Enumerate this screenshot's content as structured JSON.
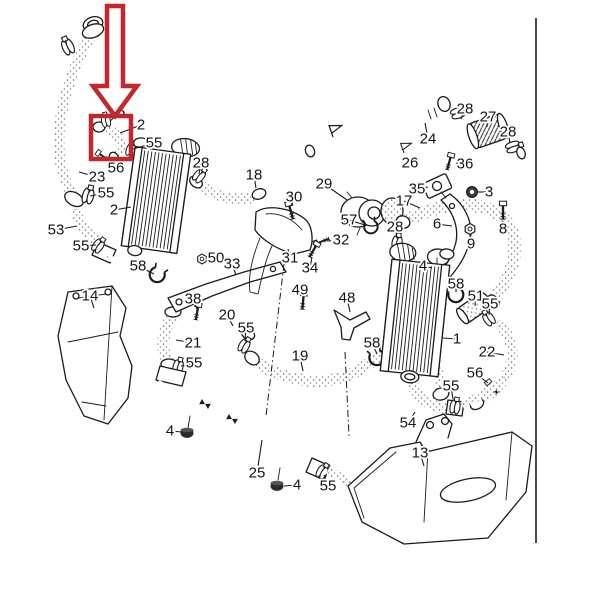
{
  "diagram": {
    "kind": "exploded-parts-diagram",
    "visible_part_numbers": [
      "1",
      "2",
      "3",
      "4",
      "5",
      "6",
      "8",
      "9",
      "13",
      "14",
      "17",
      "18",
      "19",
      "20",
      "21",
      "22",
      "23",
      "24",
      "25",
      "26",
      "27",
      "28",
      "29",
      "30",
      "31",
      "32",
      "33",
      "34",
      "35",
      "36",
      "38",
      "48",
      "49",
      "50",
      "51",
      "53",
      "54",
      "55",
      "56",
      "57",
      "58"
    ]
  },
  "colors": {
    "background": "#ffffff",
    "line": "#1b1b1b",
    "label": "#141414",
    "highlight": "#c1272d"
  },
  "frame": {
    "right_border": {
      "x": 536,
      "y1": 18,
      "y2": 543
    }
  },
  "highlight": {
    "box": {
      "x": 91,
      "y": 116,
      "w": 40,
      "h": 43
    },
    "arrow_points": "107,6 123,6 123,86 137,86 115,116 93,86 107,86",
    "stroke_width": 4.5
  },
  "labels": [
    {
      "n": "5",
      "x": 121,
      "y": 112,
      "lx": 110,
      "ly": 121
    },
    {
      "n": "2",
      "x": 141,
      "y": 125,
      "lx": 120,
      "ly": 133
    },
    {
      "n": "55",
      "x": 154,
      "y": 143,
      "lx": 133,
      "ly": 149
    },
    {
      "n": "56",
      "x": 116,
      "y": 168,
      "lx": 105,
      "ly": 158
    },
    {
      "n": "23",
      "x": 97,
      "y": 177,
      "lx": 79,
      "ly": 172
    },
    {
      "n": "55",
      "x": 106,
      "y": 193,
      "lx": 90,
      "ly": 196
    },
    {
      "n": "2",
      "x": 114,
      "y": 210,
      "lx": 131,
      "ly": 207
    },
    {
      "n": "53",
      "x": 56,
      "y": 230,
      "lx": 77,
      "ly": 226
    },
    {
      "n": "55",
      "x": 81,
      "y": 246,
      "lx": 96,
      "ly": 245
    },
    {
      "n": "28",
      "x": 201,
      "y": 163,
      "lx": 199,
      "ly": 174
    },
    {
      "n": "18",
      "x": 254,
      "y": 175,
      "lx": 256,
      "ly": 188
    },
    {
      "n": "58",
      "x": 138,
      "y": 266,
      "lx": 154,
      "ly": 274
    },
    {
      "n": "14",
      "x": 90,
      "y": 296,
      "lx": 94,
      "ly": 308
    },
    {
      "n": "38",
      "x": 193,
      "y": 299,
      "lx": 197,
      "ly": 309
    },
    {
      "n": "20",
      "x": 227,
      "y": 315,
      "lx": 233,
      "ly": 326
    },
    {
      "n": "21",
      "x": 193,
      "y": 343,
      "lx": 176,
      "ly": 340
    },
    {
      "n": "55",
      "x": 246,
      "y": 328,
      "lx": 245,
      "ly": 341
    },
    {
      "n": "55",
      "x": 194,
      "y": 363,
      "lx": 181,
      "ly": 366
    },
    {
      "n": "4",
      "x": 170,
      "y": 431,
      "lx": 182,
      "ly": 432
    },
    {
      "n": "25",
      "x": 257,
      "y": 473,
      "lx": 262,
      "ly": 440
    },
    {
      "n": "4",
      "x": 297,
      "y": 485,
      "lx": 284,
      "ly": 486
    },
    {
      "n": "55",
      "x": 328,
      "y": 486,
      "lx": 324,
      "ly": 475
    },
    {
      "n": "13",
      "x": 420,
      "y": 453,
      "lx": 424,
      "ly": 466
    },
    {
      "n": "54",
      "x": 408,
      "y": 423,
      "lx": 415,
      "ly": 412
    },
    {
      "n": "55",
      "x": 451,
      "y": 386,
      "lx": 453,
      "ly": 399
    },
    {
      "n": "19",
      "x": 300,
      "y": 356,
      "lx": 303,
      "ly": 371
    },
    {
      "n": "58",
      "x": 372,
      "y": 343,
      "lx": 377,
      "ly": 354
    },
    {
      "n": "29",
      "x": 324,
      "y": 184,
      "lx": 347,
      "ly": 200
    },
    {
      "n": "30",
      "x": 294,
      "y": 197,
      "lx": 291,
      "ly": 206
    },
    {
      "n": "57",
      "x": 349,
      "y": 220,
      "lx": 365,
      "ly": 225
    },
    {
      "n": "28",
      "x": 395,
      "y": 227,
      "lx": 397,
      "ly": 238
    },
    {
      "n": "32",
      "x": 341,
      "y": 240,
      "lx": 328,
      "ly": 241
    },
    {
      "n": "31",
      "x": 290,
      "y": 258,
      "lx": 288,
      "ly": 249
    },
    {
      "n": "34",
      "x": 310,
      "y": 268,
      "lx": 312,
      "ly": 257
    },
    {
      "n": "49",
      "x": 300,
      "y": 290,
      "lx": 303,
      "ly": 297
    },
    {
      "n": "48",
      "x": 347,
      "y": 298,
      "lx": 350,
      "ly": 312
    },
    {
      "n": "50",
      "x": 216,
      "y": 258,
      "lx": 207,
      "ly": 259
    },
    {
      "n": "33",
      "x": 232,
      "y": 264,
      "lx": 236,
      "ly": 275
    },
    {
      "n": "17",
      "x": 404,
      "y": 201,
      "lx": 420,
      "ly": 208
    },
    {
      "n": "26",
      "x": 410,
      "y": 163,
      "lx": 405,
      "ly": 156
    },
    {
      "n": "36",
      "x": 465,
      "y": 164,
      "lx": 456,
      "ly": 163
    },
    {
      "n": "35",
      "x": 417,
      "y": 189,
      "lx": 428,
      "ly": 187
    },
    {
      "n": "3",
      "x": 489,
      "y": 192,
      "lx": 478,
      "ly": 192
    },
    {
      "n": "6",
      "x": 437,
      "y": 224,
      "lx": 452,
      "ly": 226
    },
    {
      "n": "8",
      "x": 503,
      "y": 229,
      "lx": 503,
      "ly": 221
    },
    {
      "n": "9",
      "x": 471,
      "y": 244,
      "lx": 470,
      "ly": 235
    },
    {
      "n": "4",
      "x": 423,
      "y": 266,
      "lx": 432,
      "ly": 268
    },
    {
      "n": "58",
      "x": 456,
      "y": 284,
      "lx": 456,
      "ly": 292
    },
    {
      "n": "51",
      "x": 476,
      "y": 296,
      "lx": 475,
      "ly": 306
    },
    {
      "n": "55",
      "x": 490,
      "y": 304,
      "lx": 489,
      "ly": 315
    },
    {
      "n": "1",
      "x": 457,
      "y": 339,
      "lx": 443,
      "ly": 338
    },
    {
      "n": "22",
      "x": 487,
      "y": 352,
      "lx": 504,
      "ly": 355
    },
    {
      "n": "56",
      "x": 475,
      "y": 373,
      "lx": 488,
      "ly": 383
    },
    {
      "n": "24",
      "x": 428,
      "y": 139,
      "lx": 425,
      "ly": 123
    },
    {
      "n": "27",
      "x": 488,
      "y": 117,
      "lx": 487,
      "ly": 127
    },
    {
      "n": "28",
      "x": 465,
      "y": 109,
      "lx": 461,
      "ly": 119
    },
    {
      "n": "28",
      "x": 508,
      "y": 132,
      "lx": 510,
      "ly": 143
    }
  ]
}
